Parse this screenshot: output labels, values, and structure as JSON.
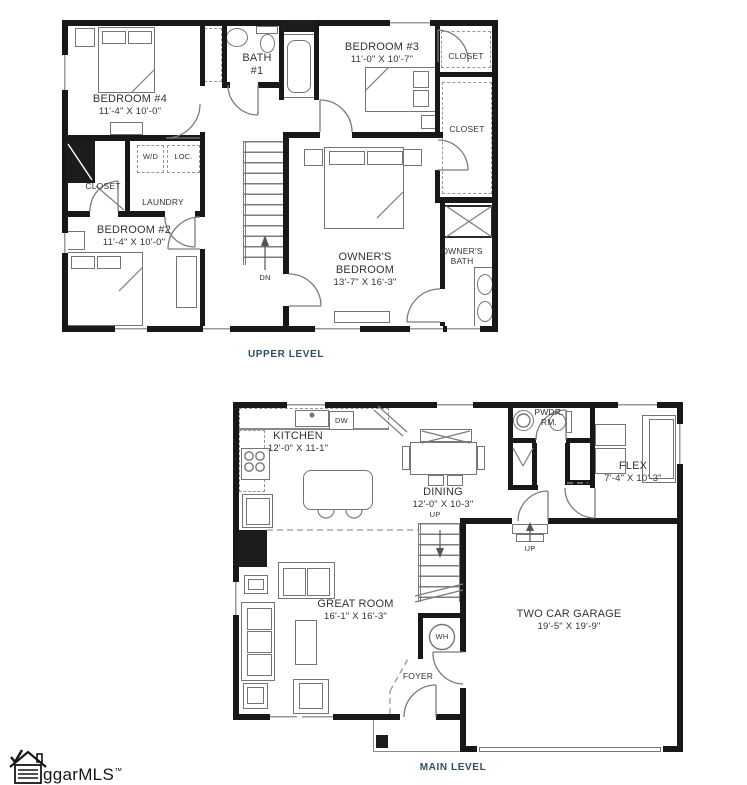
{
  "colors": {
    "level_caption": "#2d4f66",
    "wall": "#181818",
    "linework": "#757575",
    "label_text": "#333333"
  },
  "upper_level": {
    "caption": "UPPER LEVEL",
    "bedroom4": {
      "name": "BEDROOM #4",
      "dims": "11'-4\" X 10'-0\""
    },
    "bath1": {
      "line1": "BATH",
      "line2": "#1"
    },
    "bedroom3": {
      "name": "BEDROOM #3",
      "dims": "11'-0\" X 10'-7\""
    },
    "closet_top": "CLOSET",
    "closet_right": "CLOSET",
    "closet_left": "CLOSET",
    "laundry": "LAUNDRY",
    "washer_dryer": "W/D",
    "loc": "LOC.",
    "bedroom2": {
      "name": "BEDROOM #2",
      "dims": "11'-4\" X 10'-0\""
    },
    "owners_bedroom": {
      "line1": "OWNER'S",
      "line2": "BEDROOM",
      "dims": "13'-7\" X 16'-3\""
    },
    "owners_bath": {
      "line1": "OWNER'S",
      "line2": "BATH"
    },
    "stairs_dn": "DN"
  },
  "main_level": {
    "caption": "MAIN LEVEL",
    "kitchen": {
      "name": "KITCHEN",
      "dims": "12'-0\" X 11-1\""
    },
    "dishwasher": "DW",
    "dining": {
      "name": "DINING",
      "dims": "12'-0\" X 10-3\""
    },
    "powder_room": {
      "line1": "PWDR.",
      "line2": "RM."
    },
    "flex": {
      "name": "FLEX",
      "dims": "7'-4\" X 10'-3\""
    },
    "great_room": {
      "name": "GREAT ROOM",
      "dims": "16'-1\" X 16'-3\""
    },
    "garage": {
      "name": "TWO CAR GARAGE",
      "dims": "19'-5\" X 19'-9\""
    },
    "foyer": "FOYER",
    "water_heater": "WH",
    "stairs_up": "UP",
    "garage_step_up": "UP"
  },
  "footer": {
    "logo_text": "ggarMLS",
    "trademark": "™"
  }
}
